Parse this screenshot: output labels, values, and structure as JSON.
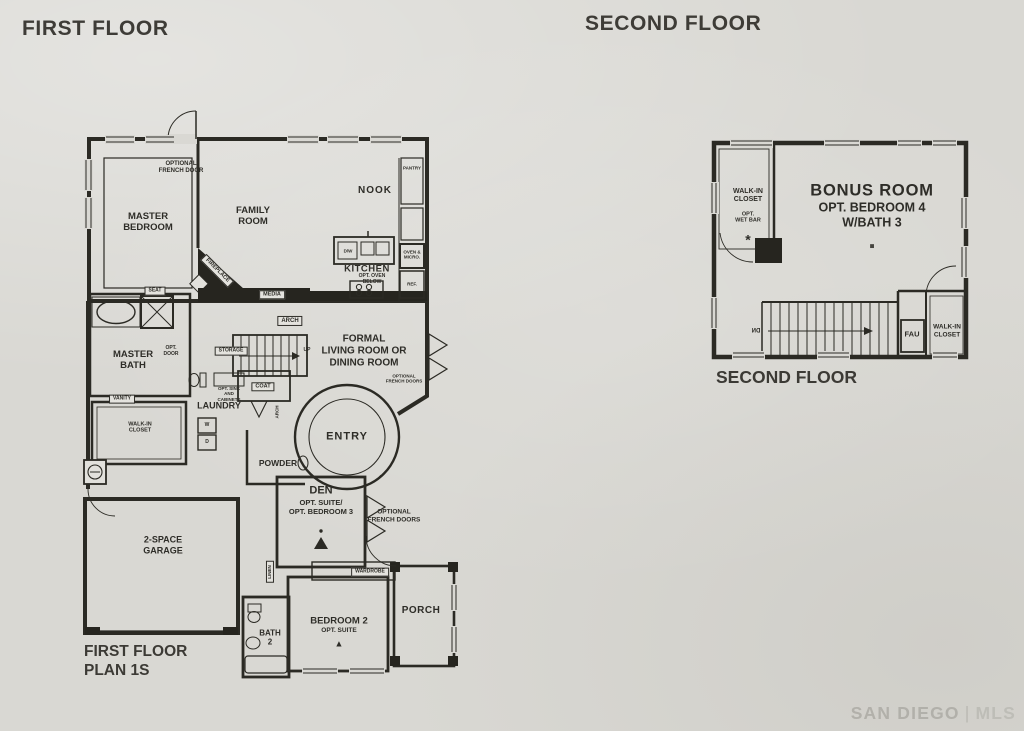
{
  "meta": {
    "paper_color": "#d9d8d3",
    "ink_color": "#2b2a24",
    "watermark_color": "#b4b2ab"
  },
  "headings": {
    "first": "FIRST FLOOR",
    "second": "SECOND FLOOR"
  },
  "first_floor": {
    "caption": "FIRST FLOOR\nPLAN 1S",
    "rooms": {
      "master_bedroom": "MASTER\nBEDROOM",
      "family_room": "FAMILY\nROOM",
      "nook": "NOOK",
      "kitchen": "KITCHEN",
      "master_bath": "MASTER\nBATH",
      "walk_in_closet": "WALK-IN\nCLOSET",
      "laundry": "LAUNDRY",
      "formal_living": "FORMAL\nLIVING ROOM OR\nDINING ROOM",
      "entry": "ENTRY",
      "powder": "POWDER",
      "den_title": "DEN",
      "den_subtitle": "OPT. SUITE/\nOPT. BEDROOM 3",
      "garage": "2-SPACE\nGARAGE",
      "bath_2": "BATH\n2",
      "bedroom_2_title": "BEDROOM 2",
      "bedroom_2_subtitle": "OPT. SUITE",
      "porch": "PORCH"
    },
    "annotations": {
      "optional_french_door": "OPTIONAL\nFRENCH DOOR",
      "fireplace": "FIREPLACE",
      "media": "MEDIA",
      "seat": "SEAT",
      "opt_door": "OPT.\nDOOR",
      "arch_upper": "ARCH",
      "arch_entry": "ARCH",
      "storage": "STORAGE",
      "up": "UP",
      "vanity": "VANITY",
      "opt_sink_cabinets": "OPT. SINK\nAND\nCABINETS",
      "coat": "COAT",
      "washer": "W",
      "dryer": "D",
      "optional_french_doors_living": "OPTIONAL\nFRENCH DOORS",
      "optional_french_doors_den": "OPTIONAL\nFRENCH DOORS",
      "linen": "LINEN",
      "wardrobe": "WARDROBE",
      "pantry": "PANTRY",
      "oven_micro": "OVEN &\nMICRO.",
      "ref": "REF.",
      "dishwasher": "D/W",
      "opt_oven_below": "OPT. OVEN\nBELOW",
      "den_marker": "▲",
      "bedroom_2_marker": "▲"
    }
  },
  "second_floor": {
    "caption": "SECOND FLOOR",
    "rooms": {
      "bonus_title": "BONUS ROOM",
      "bonus_subtitle": "OPT. BEDROOM 4\nW/BATH 3",
      "wic_title": "WALK-IN\nCLOSET",
      "wic_subtitle": "OPT.\nWET BAR",
      "walk_in_closet": "WALK-IN\nCLOSET",
      "fau": "FAU"
    },
    "annotations": {
      "down": "DN",
      "asterisk": "*",
      "bonus_marker": "■"
    }
  },
  "watermark": {
    "brand": "SAN DIEGO",
    "separator": "|",
    "suffix": "MLS"
  }
}
